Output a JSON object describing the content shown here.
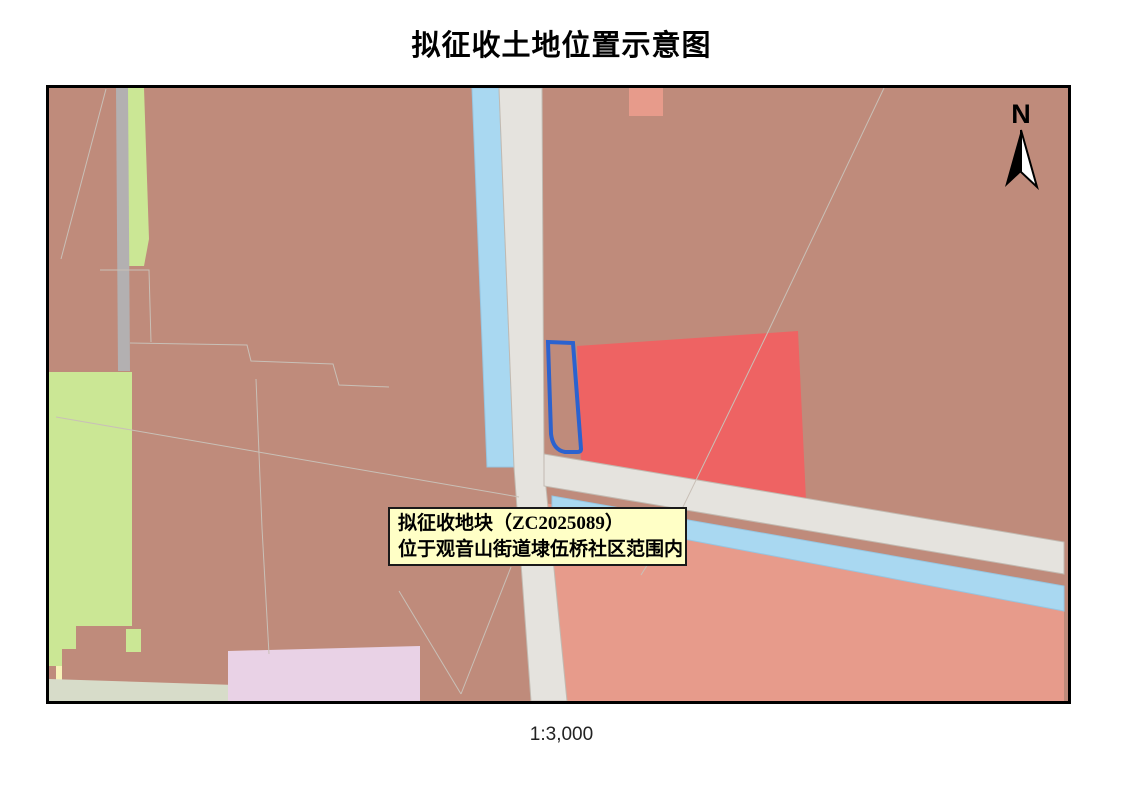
{
  "title": "拟征收土地位置示意图",
  "map": {
    "annotation": {
      "line1": "拟征收地块（ZC2025089）",
      "line2": "位于观音山街道埭伍桥社区范围内"
    },
    "parcel_code": "ZC2025089",
    "north_label": "N",
    "scale_label": "1:3,000"
  },
  "colors": {
    "background_parcel": "#bf8b7b",
    "highlight_parcel_outline": "#2b62cf",
    "red_parcel": "#ee6363",
    "salmon_parcel": "#e79b8b",
    "green_parcel": "#cbe795",
    "pink_parcel": "#e9d2e6",
    "pale_yellow_parcel": "#f6f2b8",
    "river": "#a9d8f1",
    "road_major": "#e5e3de",
    "road_minor": "#b3b0b1",
    "road_rural": "#d7dcc9",
    "annotation_bg": "#ffffc6",
    "frame": "#000000"
  }
}
